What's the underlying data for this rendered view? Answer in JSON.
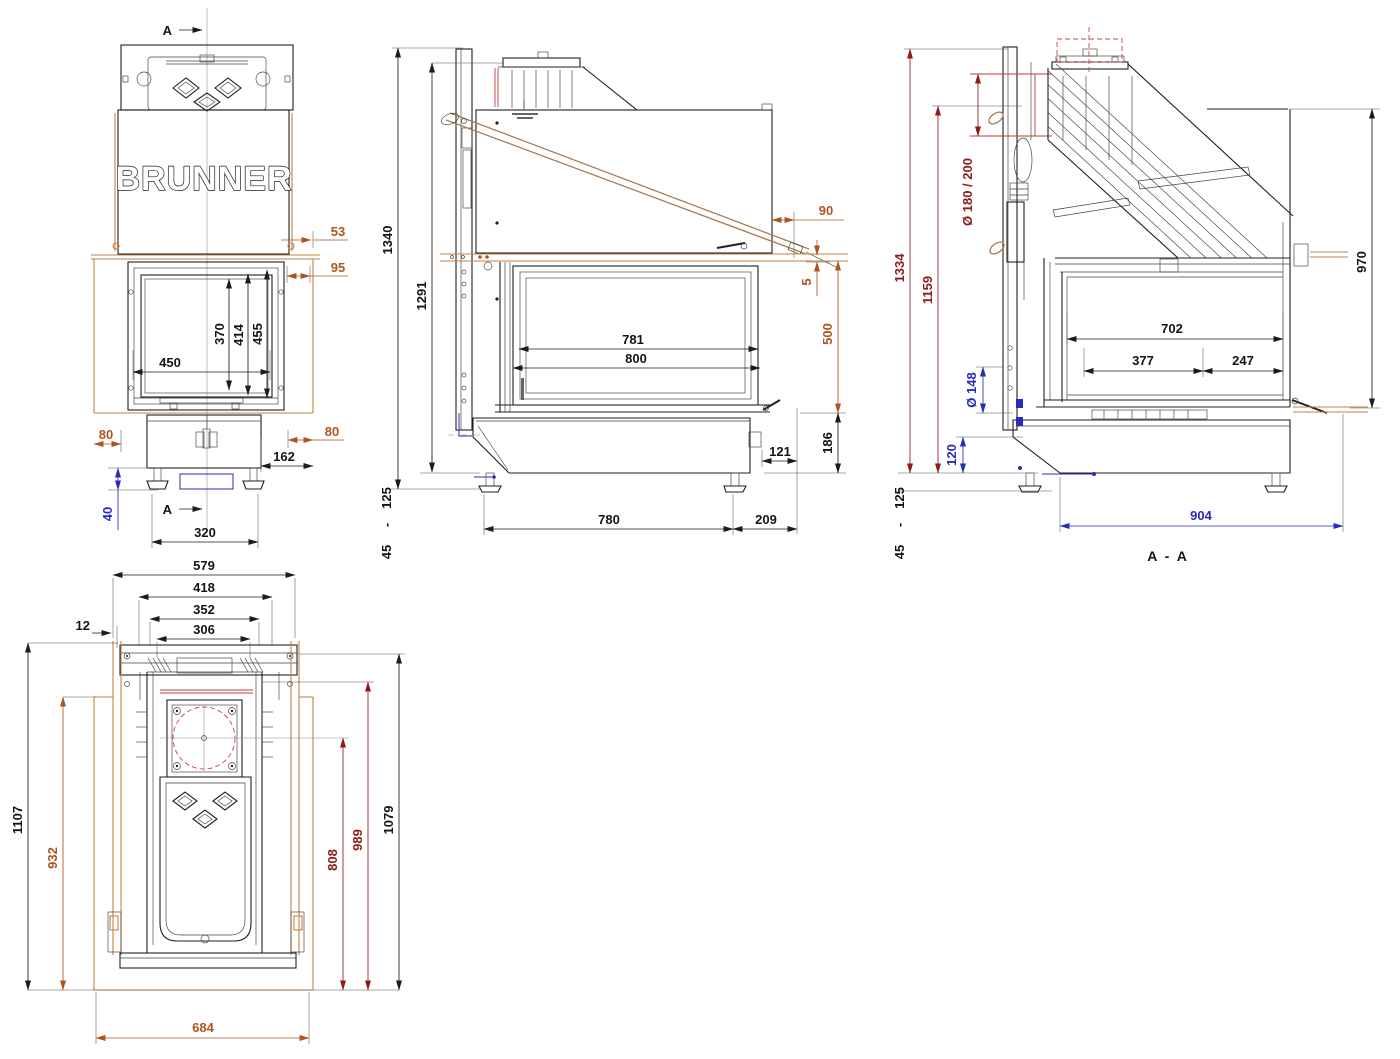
{
  "brand": "BRUNNER",
  "colors": {
    "outline": "#1f1f1f",
    "dim_black": "#141414",
    "dim_orange": "#ad5420",
    "dim_blue": "#2a2ac0",
    "dim_dark_red": "#8e1a1a",
    "wood_orange": "#c5813f",
    "accent_red": "#cc4343",
    "rod_tan": "#a87c56"
  },
  "views": {
    "front": {
      "section_marker_top": "A",
      "section_marker_bottom": "A",
      "dims": {
        "d53": "53",
        "d95": "95",
        "d450": "450",
        "d370": "370",
        "d414": "414",
        "d455": "455",
        "d80l": "80",
        "d80r": "80",
        "d162": "162",
        "d40": "40",
        "d320": "320"
      }
    },
    "side": {
      "dims": {
        "d1340": "1340",
        "d1291": "1291",
        "d90": "90",
        "d5": "5",
        "d500": "500",
        "d781": "781",
        "d800": "800",
        "d186": "186",
        "d121": "121",
        "d125": "125",
        "dash": "-",
        "d45": "45",
        "d780": "780",
        "d209": "209"
      }
    },
    "section": {
      "title": "A  -  A",
      "dims": {
        "d1334": "1334",
        "d1159": "1159",
        "dflue": "Ø  180  /  200",
        "d970": "970",
        "d702": "702",
        "d377": "377",
        "d247": "247",
        "d148": "Ø  148",
        "d120": "120",
        "d125": "125",
        "dash": "-",
        "d45": "45",
        "d904": "904"
      }
    },
    "top": {
      "dims": {
        "d579": "579",
        "d418": "418",
        "d352": "352",
        "d306": "306",
        "d12": "12",
        "d1107": "1107",
        "d932": "932",
        "d808": "808",
        "d989": "989",
        "d1079": "1079",
        "d684": "684"
      }
    }
  }
}
